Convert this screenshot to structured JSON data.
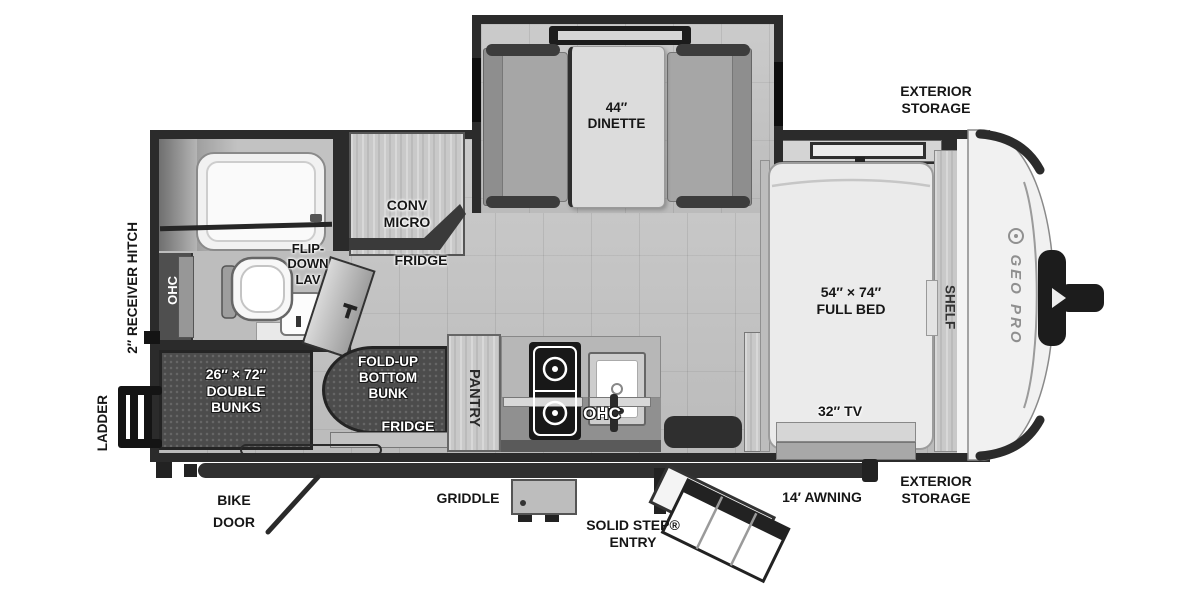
{
  "page": {
    "background": "#ffffff",
    "description": "Travel trailer floor plan diagram, top view"
  },
  "colors": {
    "wall": "#2b2b2b",
    "floor_tile": "#c5c5c5",
    "wood_cabinet": "#c9c9c9",
    "bunk_dark": "#4c4c4c",
    "cushion_gray": "#a6a6a6",
    "label_black": "#161616",
    "label_white": "#ffffff"
  },
  "labels": {
    "exterior_storage_top": {
      "lines": [
        "EXTERIOR",
        "STORAGE"
      ]
    },
    "exterior_storage_bottom": {
      "lines": [
        "EXTERIOR",
        "STORAGE"
      ]
    },
    "dinette": {
      "lines": [
        "44″",
        "DINETTE"
      ]
    },
    "full_bed": {
      "lines": [
        "54″ × 74″",
        "FULL BED"
      ]
    },
    "double_bunks": {
      "lines": [
        "26″ × 72″",
        "DOUBLE",
        "BUNKS"
      ]
    },
    "fold_up_bottom_bunk": {
      "lines": [
        "FOLD-UP",
        "BOTTOM",
        "BUNK"
      ]
    },
    "conv_micro": {
      "lines": [
        "CONV",
        "MICRO"
      ]
    },
    "flip_down_lav": {
      "lines": [
        "FLIP-",
        "DOWN",
        "LAV"
      ]
    },
    "solid_step_entry": {
      "lines": [
        "SOLID STEP®",
        "ENTRY"
      ]
    },
    "bike_door": {
      "lines": [
        "BIKE",
        "DOOR"
      ]
    },
    "fridge_upper": "FRIDGE",
    "fridge_lower": "FRIDGE",
    "pantry": "PANTRY",
    "shelf": "SHELF",
    "ohc_bath": "OHC",
    "ohc_kitchen": "OHC",
    "tv": "32″ TV",
    "awning": "14′ AWNING",
    "griddle": "GRIDDLE",
    "ladder": "LADDER",
    "receiver_hitch": "2″ RECEIVER HITCH",
    "brand": "GEO PRO"
  }
}
